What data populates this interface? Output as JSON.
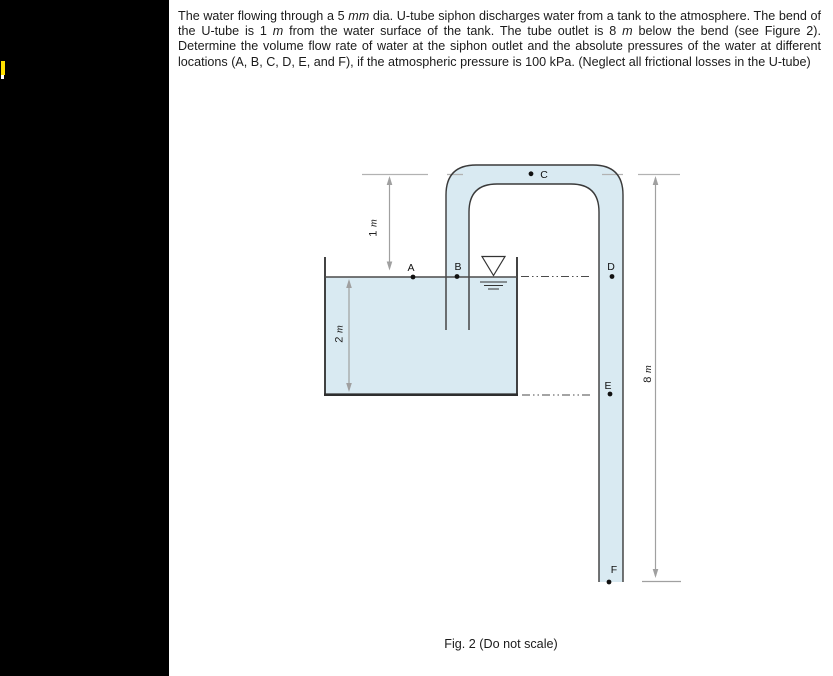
{
  "problem": {
    "segments": [
      {
        "text": "The water flowing through a 5 ",
        "italic": false
      },
      {
        "text": "mm",
        "italic": true
      },
      {
        "text": " dia. U-tube siphon discharges water from a tank to the atmosphere. The bend of the U-tube is 1 ",
        "italic": false
      },
      {
        "text": "m",
        "italic": true
      },
      {
        "text": " from the water surface of the tank. The tube outlet is 8 ",
        "italic": false
      },
      {
        "text": "m",
        "italic": true
      },
      {
        "text": " below the bend (see Figure 2). Determine the volume flow rate of water at the siphon outlet and the absolute pressures of the water at different locations (A, B, C, D, E, and F), if the atmospheric pressure is 100 kPa. (Neglect all frictional losses in the U-tube)",
        "italic": false
      }
    ]
  },
  "figure": {
    "caption": "Fig. 2 (Do not scale)",
    "points": {
      "A": "A",
      "B": "B",
      "C": "C",
      "D": "D",
      "E": "E",
      "F": "F"
    },
    "dimensions": {
      "bend_to_surface": {
        "num": "1",
        "unit": "m"
      },
      "tank_depth": {
        "num": "2",
        "unit": "m"
      },
      "bend_to_outlet": {
        "num": "8",
        "unit": "m"
      }
    },
    "colors": {
      "water": "#d9eaf2",
      "tube_outline": "#3a3a3a",
      "dimension_gray": "#a0a0a0",
      "sidebar": "#000000",
      "highlight_marker": "#ffe100"
    }
  }
}
